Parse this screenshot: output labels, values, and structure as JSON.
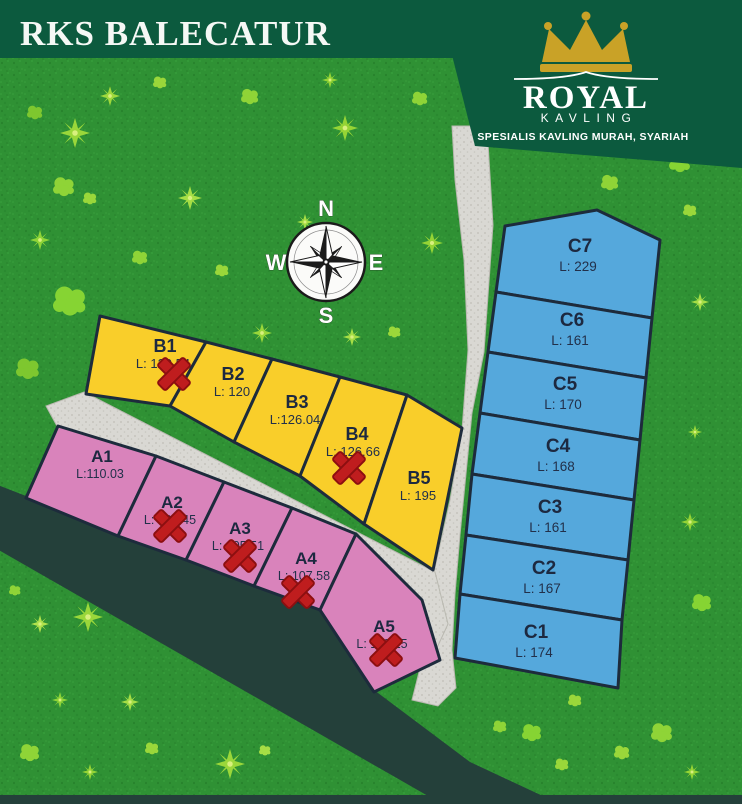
{
  "header": {
    "title": "RKS BALECATUR"
  },
  "logo": {
    "brand_line1": "ROYAL",
    "brand_line2": "KAVLING",
    "tagline": "SPESIALIS KAVLING MURAH, SYARIAH"
  },
  "compass": {
    "north": "N",
    "east": "E",
    "south": "S",
    "west": "W"
  },
  "palette": {
    "banner_green": "#0c5a3e",
    "grass_green": "#2f9134",
    "zone_a_pink": "#d983bb",
    "zone_b_yellow": "#f9ce2a",
    "zone_c_blue": "#55a8dc",
    "road_light": "#d9d8d3",
    "road_dark": "#24403a",
    "sold_mark_red": "#bf1d1e",
    "plot_border": "#1d2b3c",
    "crown_gold": "#c9a227"
  },
  "plots": {
    "zone_a": [
      {
        "id": "A1",
        "area": "L:110.03",
        "sold": false
      },
      {
        "id": "A2",
        "area": "L: 104.45",
        "sold": true
      },
      {
        "id": "A3",
        "area": "L: 105.51",
        "sold": true
      },
      {
        "id": "A4",
        "area": "L: 107.58",
        "sold": true
      },
      {
        "id": "A5",
        "area": "L: 110.15",
        "sold": true
      }
    ],
    "zone_b": [
      {
        "id": "B1",
        "area": "L: 120.54",
        "sold": true
      },
      {
        "id": "B2",
        "area": "L: 120",
        "sold": false
      },
      {
        "id": "B3",
        "area": "L:126.04",
        "sold": false
      },
      {
        "id": "B4",
        "area": "L: 126.66",
        "sold": true
      },
      {
        "id": "B5",
        "area": "L: 195",
        "sold": false
      }
    ],
    "zone_c": [
      {
        "id": "C1",
        "area": "L: 174",
        "sold": false
      },
      {
        "id": "C2",
        "area": "L: 167",
        "sold": false
      },
      {
        "id": "C3",
        "area": "L: 161",
        "sold": false
      },
      {
        "id": "C4",
        "area": "L: 168",
        "sold": false
      },
      {
        "id": "C5",
        "area": "L: 170",
        "sold": false
      },
      {
        "id": "C6",
        "area": "L: 161",
        "sold": false
      },
      {
        "id": "C7",
        "area": "L: 229",
        "sold": false
      }
    ]
  }
}
